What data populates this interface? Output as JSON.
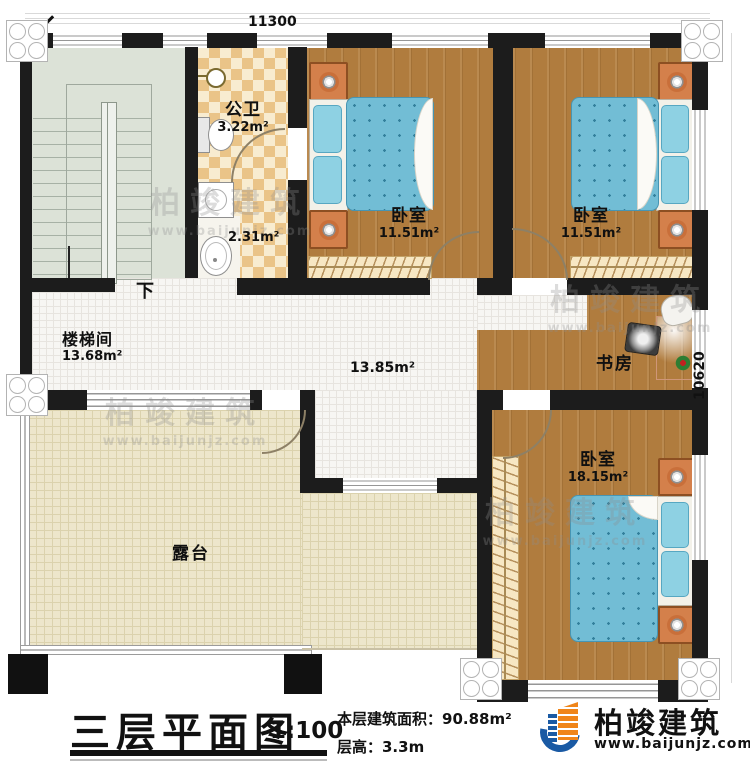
{
  "dimensions": {
    "top_width": "11300",
    "right_height": "10620"
  },
  "rooms": {
    "stairwell": {
      "label": "楼梯间",
      "area": "13.68m²",
      "direction": "下"
    },
    "bathroom": {
      "label": "公卫",
      "area": "3.22m²"
    },
    "washroom": {
      "area": "2.31m²"
    },
    "bedroom1": {
      "label": "卧室",
      "area": "11.51m²"
    },
    "bedroom2": {
      "label": "卧室",
      "area": "11.51m²"
    },
    "bedroom3": {
      "label": "卧室",
      "area": "18.15m²"
    },
    "study": {
      "label": "书房"
    },
    "hall": {
      "area": "13.85m²"
    },
    "terrace": {
      "label": "露台"
    }
  },
  "title_block": {
    "title": "三层平面图",
    "scale": "1:100",
    "floor_area_label": "本层建筑面积：90.88m²",
    "floor_height_label": "层高：3.3m"
  },
  "brand": {
    "name": "柏竣建筑",
    "website": "www.baijunjz.com"
  },
  "colors": {
    "wall": "#1c1c1c",
    "wood_floor": "#b07c3e",
    "tile_dark": "#eac488",
    "tile_light": "#f8ecd0",
    "hall_floor": "#f7f6f3",
    "terrace_floor": "#ede6cb",
    "stair_floor": "#dce2d7",
    "mattress_blue": "#72bdd5",
    "nightstand_orange": "#d4804b",
    "logo_blue": "#1a5aa4",
    "logo_orange": "#f08519"
  }
}
